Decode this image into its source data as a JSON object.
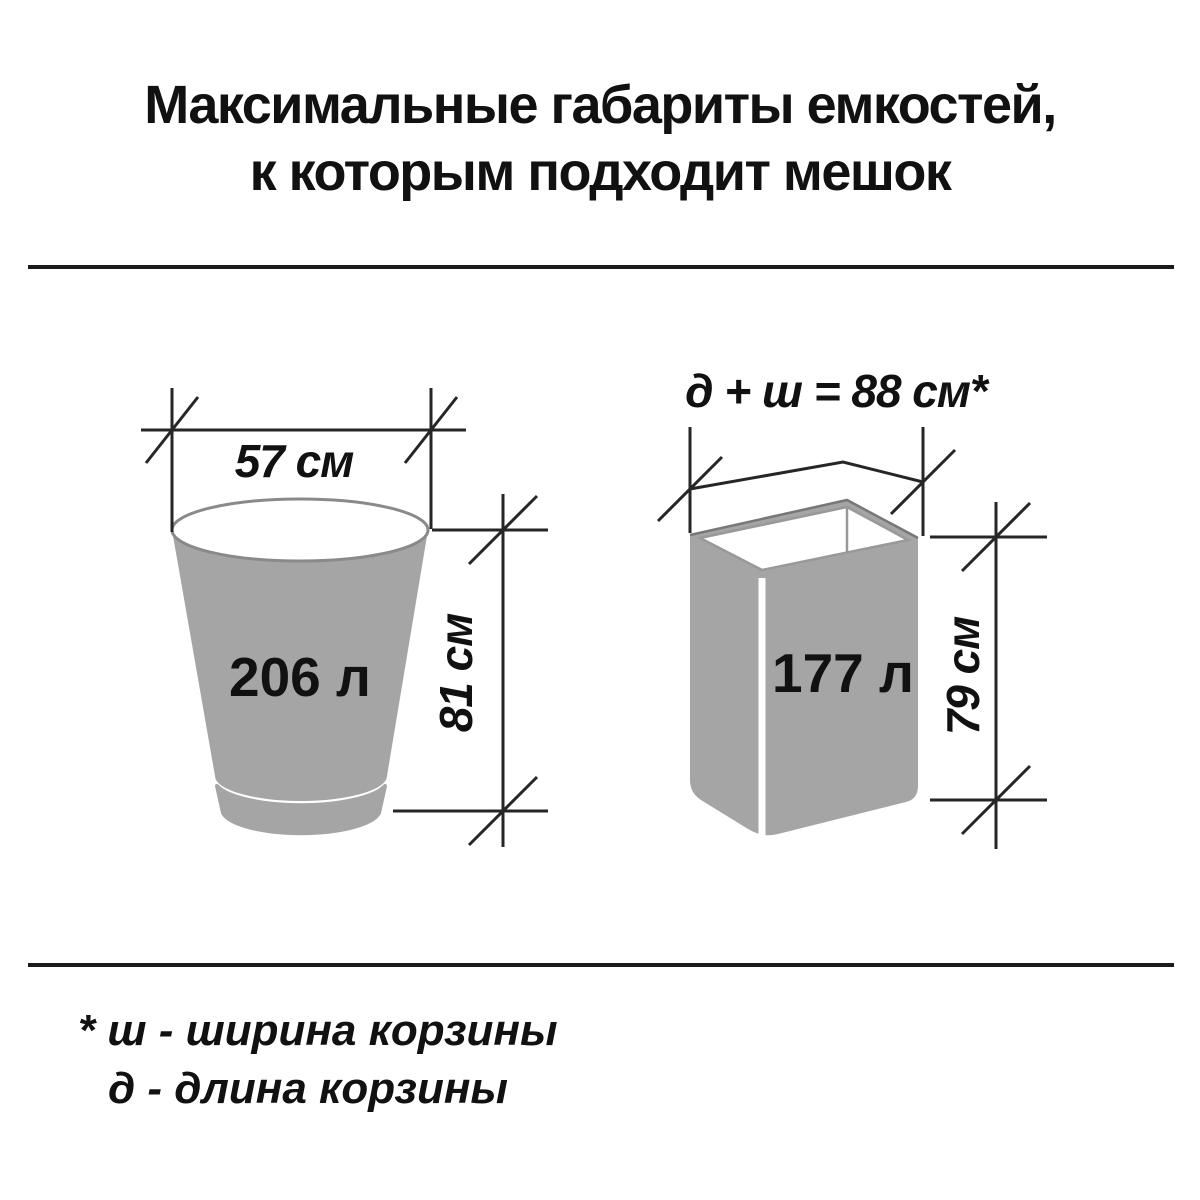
{
  "title": {
    "line1": "Максимальные габариты емкостей,",
    "line2": "к которым подходит мешок"
  },
  "bucket": {
    "width": "57 см",
    "volume": "206 л",
    "height": "81 см"
  },
  "basket": {
    "formula": "д + ш = 88 см*",
    "volume": "177 л",
    "height": "79 см"
  },
  "footnote": {
    "line1": "* ш - ширина корзины",
    "line2": "д - длина корзины"
  },
  "colors": {
    "background": "#ffffff",
    "container_fill": "#a5a5a5",
    "container_outline": "#8a8a8a",
    "inner_edge": "#999999",
    "dimension_line": "#262626",
    "text": "#111111"
  }
}
